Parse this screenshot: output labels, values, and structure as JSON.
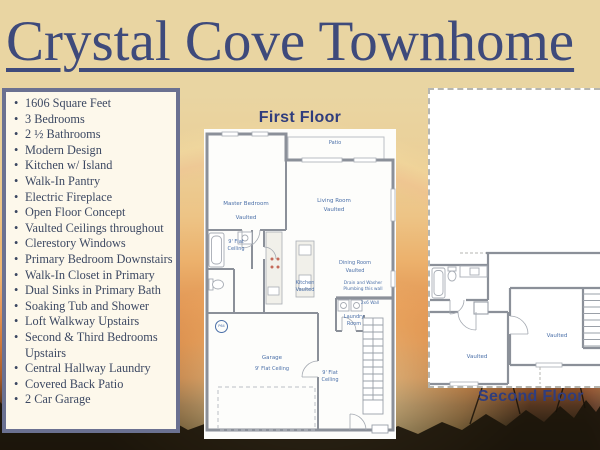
{
  "title": {
    "text": "Crystal Cove Townhome"
  },
  "features": {
    "items": [
      "1606 Square Feet",
      "3 Bedrooms",
      "2 ½ Bathrooms",
      "Modern Design",
      "Kitchen w/ Island",
      "Walk-In Pantry",
      "Electric Fireplace",
      "Open Floor Concept",
      "Vaulted Ceilings throughout",
      "Clerestory Windows",
      "Primary Bedroom Downstairs",
      "Walk-In Closet in Primary",
      "Dual Sinks in Primary Bath",
      "Soaking Tub and Shower",
      "Loft Walkway Upstairs",
      "Second & Third Bedrooms Upstairs",
      "Central Hallway Laundry",
      "Covered Back Patio",
      "2 Car Garage"
    ]
  },
  "first_floor": {
    "heading": "First Floor",
    "rooms": {
      "master_bedroom": "Master Bedroom",
      "master_bedroom_note": "Vaulted",
      "patio": "Patio",
      "living_room": "Living Room",
      "living_room_note": "Vaulted",
      "bath_note": "9' Flat Ceiling",
      "kitchen": "Kitchen",
      "kitchen_note": "Vaulted",
      "dining_room": "Dining Room",
      "dining_room_note": "Vaulted",
      "plumbing_note": "Drain and Washer Plumbing this wall",
      "wall_note": "2x6 Wall",
      "laundry_room": "Laundry Room",
      "garage": "Garage",
      "garage_note": "9' Flat Ceiling",
      "hall_note": "9' Flat Ceiling",
      "plan_mark": "P64"
    }
  },
  "second_floor": {
    "heading": "Second Floor",
    "rooms": {
      "left_bedroom_note": "Vaulted",
      "right_bedroom_note": "Vaulted"
    }
  },
  "colors": {
    "title_navy": "#3e4a7b",
    "heading_navy": "#303d7d",
    "panel_border": "#6b7191",
    "panel_bg": "#fdf8eb",
    "plan_label_blue": "#4a6fa8",
    "bg_tan": "#e9d5a2",
    "bg_orange": "#e29654"
  }
}
